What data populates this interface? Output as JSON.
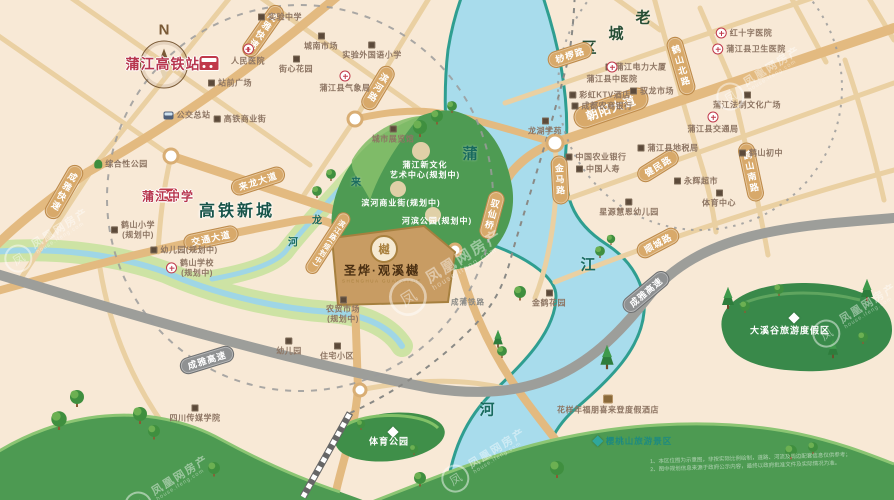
{
  "compass": {
    "n": "N"
  },
  "landmarks": {
    "station": "蒲江高铁站",
    "school": "蒲江中学"
  },
  "districts": {
    "new_town": "高铁新城",
    "old_town": [
      "老",
      "城",
      "区"
    ]
  },
  "rivers": {
    "pu": "蒲",
    "jiang": "江",
    "he": "河",
    "lailong": [
      "来",
      "龙",
      "河"
    ]
  },
  "project": {
    "name": "圣烨·观溪樾",
    "sub": "SHENGHUA GUANXIYUE",
    "logo": "樾"
  },
  "road_labels": [
    "成雅快速",
    "成雅快速",
    "滨河路",
    "驭仙桥",
    "金马路",
    "鹤山北路",
    "鹤山南路",
    "滨江路(规划中)",
    "来龙大道",
    "交通大道",
    "朝阳大道",
    "桫椤路",
    "健民路",
    "顺城路"
  ],
  "highway_labels": [
    "成雅高速",
    "成雅高速"
  ],
  "railway_label": "成蒲铁路",
  "park_labels": {
    "culture_l1": "蒲江新文化",
    "culture_l2": "艺术中心(规划中)",
    "riverside_street": "滨河商业街(规划中)",
    "riverside_park": "河滨公园(规划中)",
    "sports_park": "体育公园",
    "daxigu": "大溪谷旅游度假区",
    "cherry_hill": "樱桃山旅游景区"
  },
  "pois": [
    {
      "label": "实验中学"
    },
    {
      "label": "城南市场"
    },
    {
      "label": "实验外国语小学"
    },
    {
      "label": "街心花园"
    },
    {
      "label": "蒲江县气象局"
    },
    {
      "label": "人民医院"
    },
    {
      "label": "站前广场"
    },
    {
      "label": "公交总站"
    },
    {
      "label": "高铁商业街"
    },
    {
      "label": "城市展览馆"
    },
    {
      "label": "综合性公园"
    },
    {
      "l1": "鹤山小学",
      "l2": "(规划中)"
    },
    {
      "label": "幼儿园(规划中)"
    },
    {
      "l1": "鹤山学校",
      "l2": "(规划中)"
    },
    {
      "l1": "农贸市场",
      "l2": "(规划中)"
    },
    {
      "label": "幼儿园"
    },
    {
      "label": "住宅小区"
    },
    {
      "label": "四川传媒学院"
    },
    {
      "label": "红十字医院"
    },
    {
      "label": "蒲江县卫生医院"
    },
    {
      "label": "蒲江电力大厦"
    },
    {
      "label": "驭龙市场"
    },
    {
      "label": "彩虹KTV酒店"
    },
    {
      "label": "成都农商银行"
    },
    {
      "label": "蒲江县中医院"
    },
    {
      "label": "蒲江法制文化广场"
    },
    {
      "label": "蒲江县交通局"
    },
    {
      "label": "蒲江县地税局"
    },
    {
      "label": "鹤山初中"
    },
    {
      "label": "中国农业银行"
    },
    {
      "label": "中国人寿"
    },
    {
      "label": "永辉超市"
    },
    {
      "label": "星源慧恩幼儿园"
    },
    {
      "label": "体育中心"
    },
    {
      "label": "金鹤花园"
    },
    {
      "label": "龙湖学苑"
    },
    {
      "label": "花样年福朋喜来登度假酒店"
    }
  ],
  "watermark": {
    "cn": "凤凰网房产",
    "en": "house.ifeng.com",
    "logo": "凤"
  },
  "disclaimer": {
    "line1": "1、本区位图为示意图，非按实际比例绘制，道路、河流及周边配套信息仅供参考；",
    "line2": "2、图中规划信息来源于政府公示内容，最终以政府批准文件及实际情况为准。"
  }
}
